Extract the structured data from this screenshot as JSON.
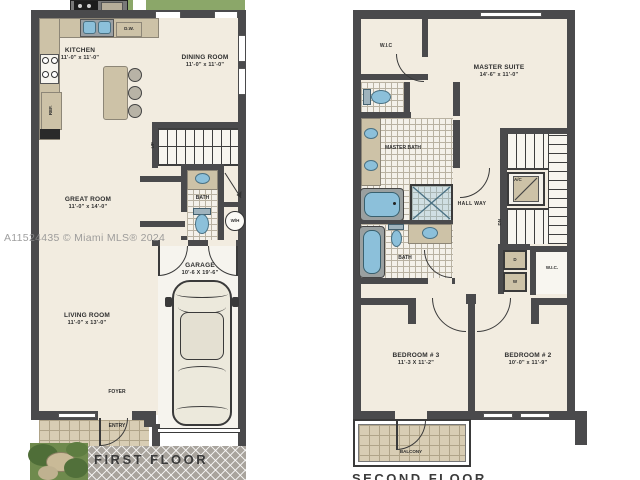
{
  "watermark": "A11524435 © Miami MLS® 2024",
  "first_floor": {
    "title": "FIRST FLOOR",
    "kitchen": {
      "name": "KITCHEN",
      "dims": "11'-0\" x 11'-0\""
    },
    "dining_room": {
      "name": "DINING ROOM",
      "dims": "11'-0\" x 11'-0\""
    },
    "great_room": {
      "name": "GREAT ROOM",
      "dims": "11'-0\" x 14'-0\""
    },
    "living_room": {
      "name": "LIVING ROOM",
      "dims": "11'-0\" x 13'-0\""
    },
    "garage": {
      "name": "GARAGE",
      "dims": "10'-6 X 19'-6\""
    },
    "bath": "BATH",
    "foyer": "FOYER",
    "entry": "ENTRY",
    "dishwasher": "D.W.",
    "refrigerator": "REF.",
    "water_heater": "W/H",
    "stairs_up": "UP"
  },
  "second_floor": {
    "title": "SECOND FLOOR",
    "wic_upper": "W.I.C",
    "master_suite": {
      "name": "MASTER SUITE",
      "dims": "14'-6\" x 11'-0\""
    },
    "master_bath": "MASTER BATH",
    "hallway": "HALL WAY",
    "bath": "BATH",
    "ac_closet": "A/C",
    "stairs_down": "DN",
    "dryer": "D",
    "washer": "W",
    "wic_lower": "W.I.C.",
    "bedroom3": {
      "name": "BEDROOM # 3",
      "dims": "11'-3 X 11'-2\""
    },
    "bedroom2": {
      "name": "BEDROOM # 2",
      "dims": "10'-0\" x 11'-9\""
    },
    "balcony": "BALCONY"
  },
  "colors": {
    "wall": "#4a4a4c",
    "floor": "#f2ece0",
    "counter_tan": "#cdc2a7",
    "fixture_blue": "#8cc0da",
    "lawn_green": "#8ba769",
    "driveway_gray": "#a9a49d"
  }
}
